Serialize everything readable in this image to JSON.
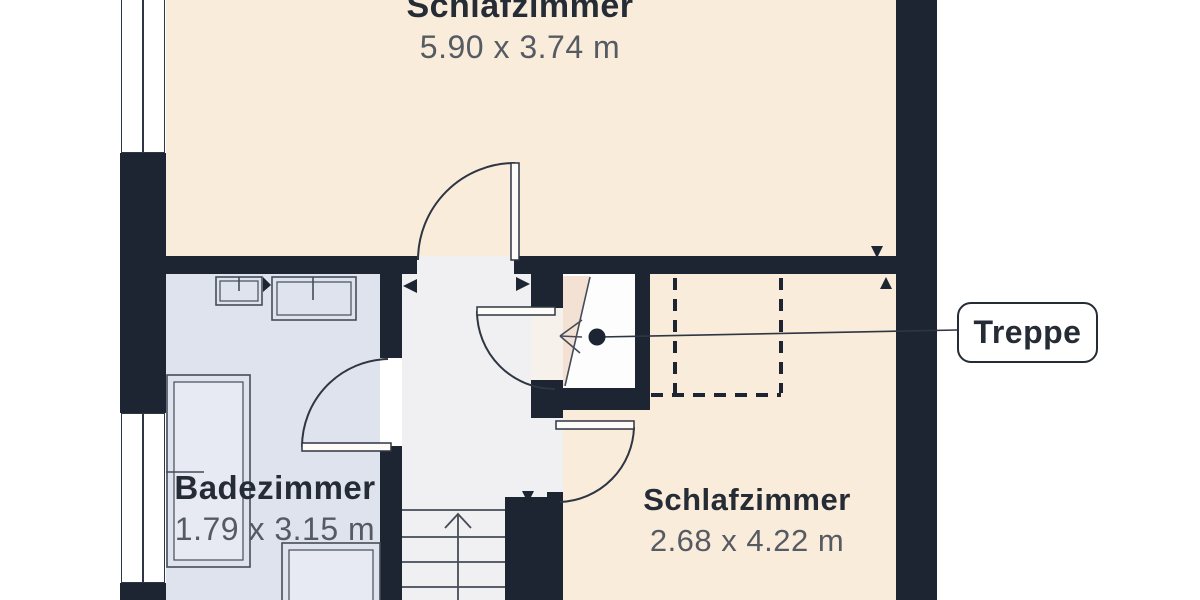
{
  "plan": {
    "rooms": [
      {
        "name": "Schlafzimmer",
        "dimensions": "5.90 x 3.74 m"
      },
      {
        "name": "Badezimmer",
        "dimensions": "1.79 x 3.15 m"
      },
      {
        "name": "Schlafzimmer",
        "dimensions": "2.68 x 4.22 m"
      }
    ],
    "callout": {
      "label": "Treppe"
    },
    "colors": {
      "wall": "#1d2533",
      "bedroom_floor": "#f9ecda",
      "bathroom_floor": "#dfe3ee",
      "hallway_floor": "#f0f0f2",
      "line": "#454b58",
      "label_text": "#262c35",
      "dimension_text": "#565b63"
    }
  }
}
